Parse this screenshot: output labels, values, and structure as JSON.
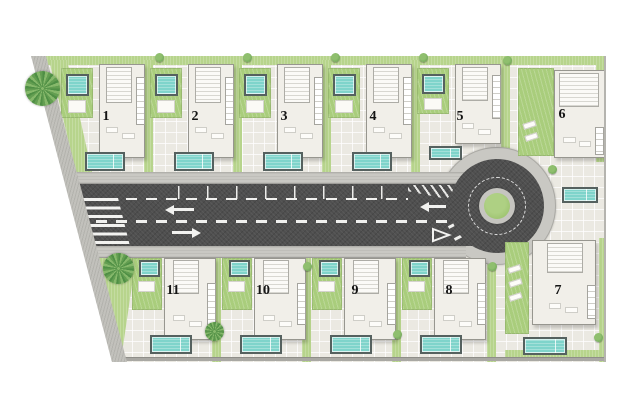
{
  "plan": {
    "type": "residential-masterplan",
    "plots": [
      {
        "number": "1"
      },
      {
        "number": "2"
      },
      {
        "number": "3"
      },
      {
        "number": "4"
      },
      {
        "number": "5"
      },
      {
        "number": "6"
      },
      {
        "number": "7"
      },
      {
        "number": "8"
      },
      {
        "number": "9"
      },
      {
        "number": "10"
      },
      {
        "number": "11"
      }
    ],
    "icons": {
      "palm_tree": "top-view palm rendered as radial frond burst",
      "shrub": "small green circle",
      "zebra_crossing": "white horizontal bars",
      "yield_marking": "white outlined triangle",
      "lane_arrows": "white left and right arrows"
    },
    "colors": {
      "paving": "#ebe9e2",
      "asphalt": "#4f4f4f",
      "sidewalk": "#c9c8c3",
      "grass": "#b7d48c",
      "lawn": "#a9cd7c",
      "pool_water": "#7fd4cb",
      "pool_border": "#55615f",
      "roundabout_island_green": "#9ec571",
      "house_fill": "#f1efe9",
      "marking_white": "#f2f2f0"
    }
  }
}
